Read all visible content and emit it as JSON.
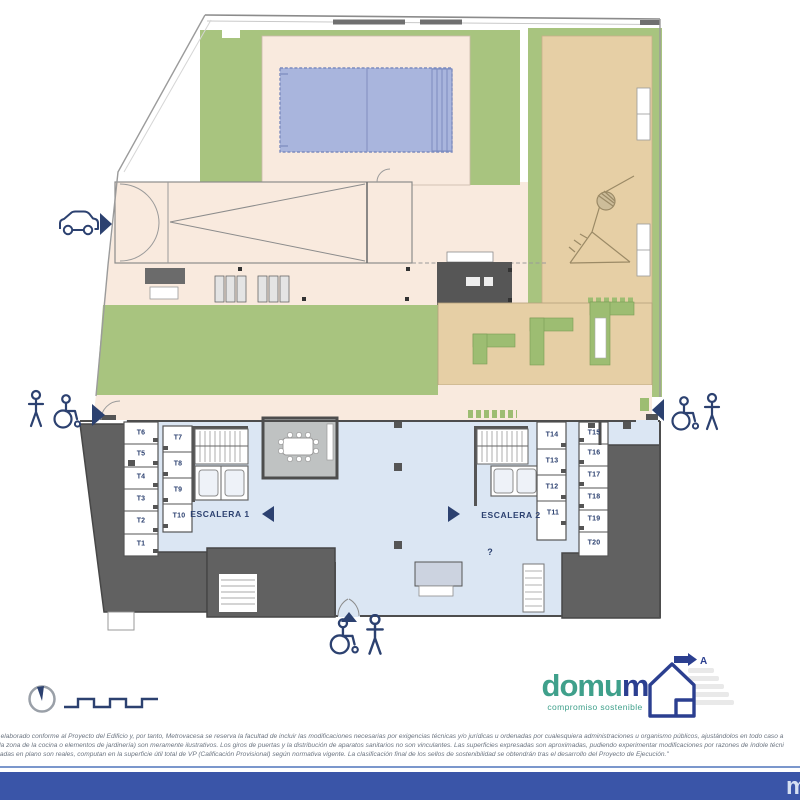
{
  "plan": {
    "stair1_label": "ESCALERA 1",
    "stair2_label": "ESCALERA 2",
    "info_mark": "?",
    "storage_left_outer": [
      "T6",
      "T5",
      "T4",
      "T3",
      "T2",
      "T1"
    ],
    "storage_left_inner": [
      "T7",
      "T8",
      "T9",
      "T10"
    ],
    "storage_right_inner": [
      "T14",
      "T13",
      "T12",
      "T11"
    ],
    "storage_right_outer": [
      "T15",
      "T16",
      "T17",
      "T18",
      "T19",
      "T20"
    ]
  },
  "logo": {
    "brand_green": "domu",
    "brand_blue": "m",
    "tagline": "compromiso sostenible",
    "energy_rating": "A"
  },
  "footer": {
    "line1": "ido elaborado conforme al Proyecto del Edificio y, por tanto, Metrovacesa se reserva la facultad de incluir las modificaciones necesarias por exigencias técnicas y/o jurídicas u ordenadas por cualesquiera administraciones u organismo públicos, ajustándolos en todo caso a",
    "line2": "en la zona de la cocina o elementos de jardinería) son meramente ilustrativos. Los giros de puertas y la distribución de aparatos sanitarios no son vinculantes. Las superficies expresadas son aproximadas, pudiendo experimentar modificaciones por razones de índole técni",
    "line3": "Dejadas en plano son reales, computan en la superficie útil total de VP (Calificación Provisional) según normativa vigente. La clasificación final de los sellos de sostenibilidad se obtendrán tras el desarrollo del Proyecto de Ejecución.\"",
    "bar_letter": "m"
  },
  "colors": {
    "garden_green": "#a8c47f",
    "bench_green": "#9dbd72",
    "deck_beige": "#f9eade",
    "terrace_tan": "#e6cfa5",
    "pool_blue": "#a9b5dd",
    "lobby_blue": "#dbe6f3",
    "wall_dark": "#616161",
    "navy": "#2c4170",
    "brand_green": "#3fa08b",
    "brand_blue": "#2b3f90",
    "footer_bar_blue": "#3a55a8"
  }
}
